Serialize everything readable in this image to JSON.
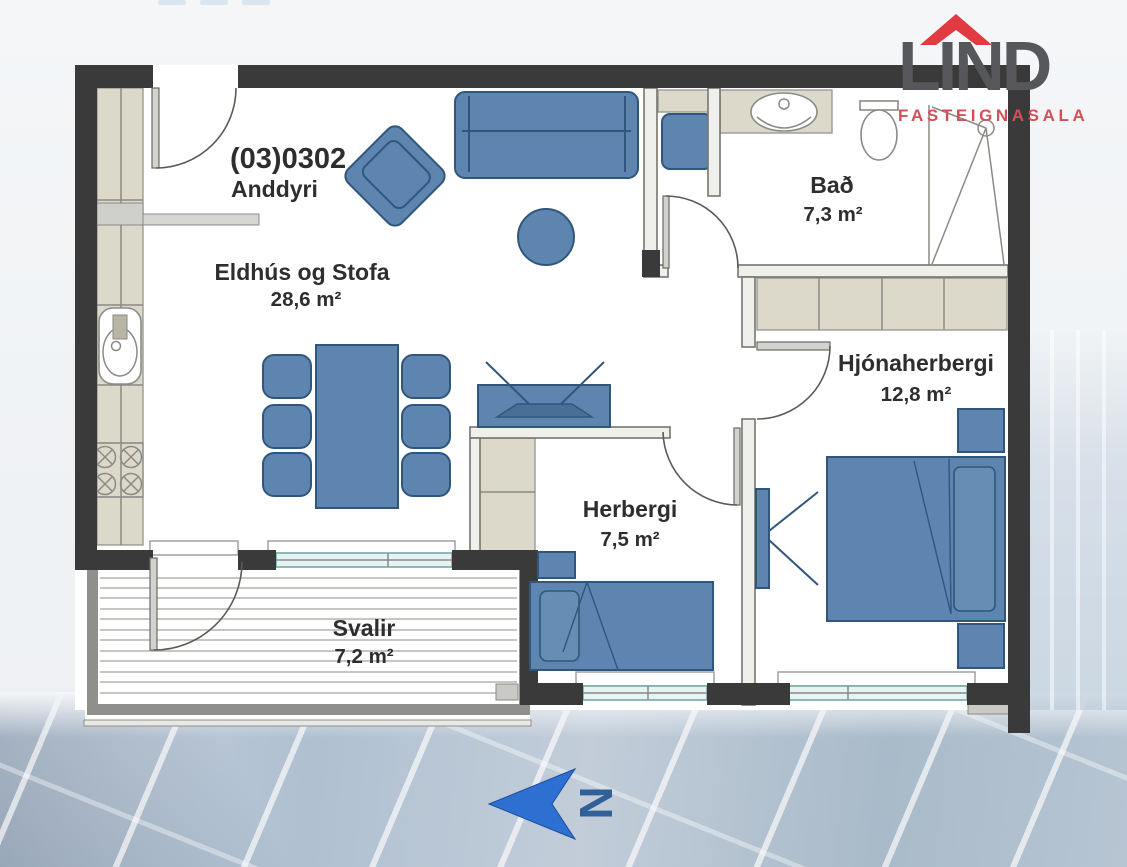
{
  "logo": {
    "name": "LIND",
    "subtitle": "FASTEIGNASALA",
    "colors": {
      "roof": "#e13a40",
      "letters": "#55575a",
      "subtitle": "#d25057"
    }
  },
  "plan": {
    "unit_number": "(03)0302",
    "rooms": [
      {
        "name": "Anddyri",
        "area": ""
      },
      {
        "name": "Eldhús og Stofa",
        "area": "28,6 m²"
      },
      {
        "name": "Bað",
        "area": "7,3 m²"
      },
      {
        "name": "Hjónaherbergi",
        "area": "12,8 m²"
      },
      {
        "name": "Herbergi",
        "area": "7,5 m²"
      },
      {
        "name": "Svalir",
        "area": "7,2 m²"
      }
    ],
    "colors": {
      "walls": "#3a3a3a",
      "interior_walls": "#8a8a86",
      "furniture": "#5d85b0",
      "furniture_outline": "#30567d",
      "counters": "#dcd8ca",
      "window_glass": "#bfdede",
      "label_text": "#2e2e2e"
    }
  },
  "compass": {
    "label": "N",
    "arrow_color": "#2e6fd2"
  }
}
